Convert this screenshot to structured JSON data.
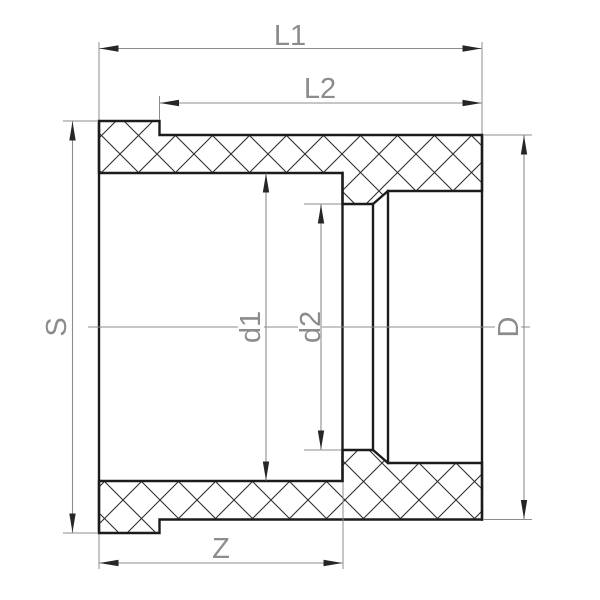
{
  "drawing": {
    "kind": "pipe-fitting-reducing-socket-cross-section",
    "labels": {
      "l1": "L1",
      "l2": "L2",
      "z": "Z",
      "s": "S",
      "d1": "d1",
      "d2": "d2",
      "d_outer": "D"
    },
    "colors": {
      "outline": "#1c1c1c",
      "hatch": "#2e2e2e",
      "dimension": "#8c8c8c",
      "arrow": "#262626",
      "background": "#ffffff"
    }
  }
}
